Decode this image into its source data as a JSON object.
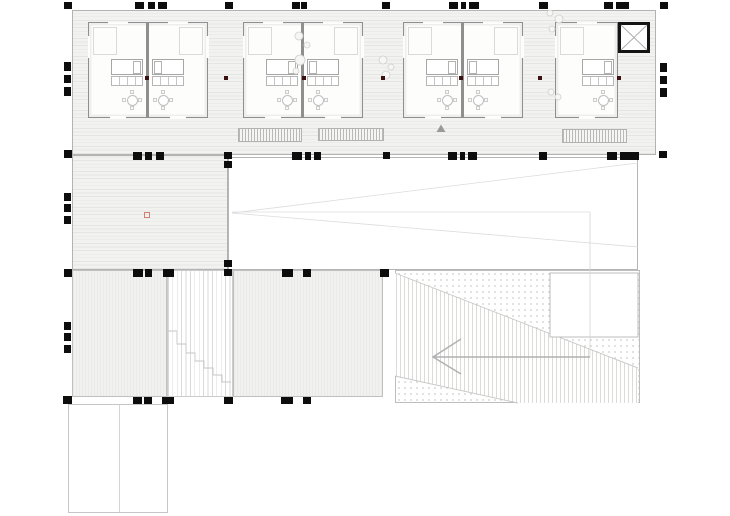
{
  "title": "architectural-roof-deck-floor-plan",
  "canvas": {
    "w": 730,
    "h": 516
  },
  "colors": {
    "background": "#ffffff",
    "deck_fill": "#f2f2f1",
    "plank_line": "#e5e5e4",
    "terrace_fill": "#f1f1f0",
    "marker_black": "#0d0d0d",
    "structural_dot": "#3c1010",
    "red_reference_square": "#d08070",
    "cabin_wall": "#8f8f8f",
    "elevator_wall": "#141414",
    "faint_line": "#dcdcdc",
    "arrow_gray": "#b0b0b0"
  },
  "regions": [
    {
      "name": "deck-band",
      "cls": "plank-h",
      "rect": [
        72,
        10,
        584,
        145
      ]
    },
    {
      "name": "deck-left-column",
      "cls": "plank-h",
      "rect": [
        72,
        155,
        156,
        115
      ]
    },
    {
      "name": "roof-void",
      "cls": "voidw",
      "rect": [
        228,
        157,
        410,
        113
      ]
    },
    {
      "name": "terrace-left",
      "cls": "stripe-v",
      "rect": [
        72,
        270,
        95,
        127
      ]
    },
    {
      "name": "stair-strip",
      "cls": "stair",
      "rect": [
        167,
        270,
        66,
        127
      ]
    },
    {
      "name": "terrace-mid",
      "cls": "stripe-v",
      "rect": [
        233,
        270,
        150,
        127
      ]
    },
    {
      "name": "ramp-area",
      "cls": "dots",
      "rect": [
        395,
        270,
        245,
        133
      ]
    },
    {
      "name": "annex",
      "cls": "annex",
      "rect": [
        68,
        404,
        100,
        109
      ]
    }
  ],
  "annex_divider_x": 119,
  "cabins": [
    {
      "name": "cabin-1",
      "rect": [
        88,
        22,
        120,
        96
      ],
      "divider": [
        145.5,
        22,
        3.5,
        96
      ],
      "rooms": [
        {
          "x": 89,
          "y": 23,
          "w": 57,
          "h": 94,
          "side": "R"
        },
        {
          "x": 149,
          "y": 23,
          "w": 58,
          "h": 94,
          "side": "L"
        }
      ]
    },
    {
      "name": "cabin-2",
      "rect": [
        243,
        22,
        120,
        96
      ],
      "divider": [
        300.5,
        22,
        3.5,
        96
      ],
      "rooms": [
        {
          "x": 244,
          "y": 23,
          "w": 57,
          "h": 94,
          "side": "R"
        },
        {
          "x": 304,
          "y": 23,
          "w": 58,
          "h": 94,
          "side": "L"
        }
      ]
    },
    {
      "name": "cabin-3",
      "rect": [
        403,
        22,
        120,
        96
      ],
      "divider": [
        460.5,
        22,
        3.5,
        96
      ],
      "rooms": [
        {
          "x": 404,
          "y": 23,
          "w": 57,
          "h": 94,
          "side": "R"
        },
        {
          "x": 464,
          "y": 23,
          "w": 58,
          "h": 94,
          "side": "L"
        }
      ]
    },
    {
      "name": "cabin-4",
      "rect": [
        555,
        22,
        63,
        96
      ],
      "divider": null,
      "rooms": [
        {
          "x": 556,
          "y": 23,
          "w": 61,
          "h": 94,
          "side": "R"
        }
      ]
    }
  ],
  "elevator": {
    "rect": [
      618,
      22,
      32,
      31
    ]
  },
  "gratings": [
    [
      238,
      128,
      64,
      14
    ],
    [
      318,
      128,
      66,
      13
    ],
    [
      562,
      129,
      65,
      14
    ]
  ],
  "markers": [
    [
      64,
      2,
      8,
      7
    ],
    [
      135,
      2,
      9,
      7
    ],
    [
      148,
      2,
      7,
      7
    ],
    [
      158,
      2,
      9,
      7
    ],
    [
      225,
      2,
      8,
      7
    ],
    [
      292,
      2,
      8,
      7
    ],
    [
      301,
      2,
      6,
      7
    ],
    [
      382,
      2,
      8,
      7
    ],
    [
      449,
      2,
      9,
      7
    ],
    [
      461,
      2,
      5,
      7
    ],
    [
      469,
      2,
      10,
      7
    ],
    [
      539,
      2,
      9,
      7
    ],
    [
      604,
      2,
      9,
      7
    ],
    [
      616,
      2,
      13,
      7
    ],
    [
      660,
      2,
      8,
      7
    ],
    [
      64,
      62,
      7,
      9
    ],
    [
      64,
      75,
      7,
      8
    ],
    [
      64,
      87,
      7,
      9
    ],
    [
      660,
      63,
      7,
      9
    ],
    [
      660,
      76,
      7,
      8
    ],
    [
      660,
      88,
      7,
      9
    ],
    [
      64,
      150,
      8,
      8
    ],
    [
      659,
      151,
      8,
      7
    ],
    [
      133,
      152,
      9,
      8
    ],
    [
      145,
      152,
      7,
      8
    ],
    [
      156,
      152,
      8,
      8
    ],
    [
      224,
      152,
      8,
      7
    ],
    [
      224,
      161,
      8,
      7
    ],
    [
      292,
      152,
      10,
      8
    ],
    [
      305,
      152,
      6,
      8
    ],
    [
      314,
      152,
      7,
      8
    ],
    [
      383,
      152,
      7,
      7
    ],
    [
      448,
      152,
      9,
      8
    ],
    [
      460,
      152,
      5,
      8
    ],
    [
      468,
      152,
      9,
      8
    ],
    [
      539,
      152,
      8,
      8
    ],
    [
      607,
      152,
      10,
      8
    ],
    [
      620,
      152,
      19,
      8
    ],
    [
      64,
      193,
      7,
      8
    ],
    [
      64,
      204,
      7,
      8
    ],
    [
      64,
      216,
      7,
      8
    ],
    [
      64,
      269,
      8,
      8
    ],
    [
      133,
      269,
      10,
      8
    ],
    [
      145,
      269,
      7,
      8
    ],
    [
      163,
      269,
      11,
      8
    ],
    [
      224,
      260,
      8,
      7
    ],
    [
      224,
      269,
      8,
      7
    ],
    [
      282,
      269,
      11,
      8
    ],
    [
      303,
      269,
      8,
      8
    ],
    [
      380,
      269,
      9,
      8
    ],
    [
      64,
      322,
      7,
      8
    ],
    [
      64,
      333,
      7,
      8
    ],
    [
      64,
      345,
      7,
      8
    ],
    [
      63,
      396,
      9,
      8
    ],
    [
      133,
      397,
      9,
      7
    ],
    [
      144,
      397,
      8,
      7
    ],
    [
      162,
      397,
      12,
      7
    ],
    [
      224,
      397,
      9,
      7
    ],
    [
      281,
      397,
      12,
      7
    ],
    [
      303,
      397,
      8,
      7
    ]
  ],
  "structural_dots": {
    "y": 76,
    "size": 4,
    "xs": [
      147,
      226,
      304,
      383,
      461,
      540,
      619
    ]
  },
  "red_square": [
    144,
    212,
    6,
    6
  ],
  "triangle_marker": "441,124.5 445.5,132 436.5,132",
  "plants": [
    [
      299,
      36,
      4
    ],
    [
      307,
      45,
      3
    ],
    [
      300,
      60,
      5
    ],
    [
      296,
      71,
      3
    ],
    [
      383,
      60,
      4
    ],
    [
      391,
      67,
      3
    ],
    [
      386,
      75,
      4
    ],
    [
      550,
      13,
      3
    ],
    [
      559,
      19,
      4
    ],
    [
      552,
      29,
      3
    ],
    [
      551,
      92,
      3
    ],
    [
      558,
      97,
      3
    ]
  ],
  "faint_lines": [
    [
      232,
      212,
      590,
      212
    ],
    [
      232,
      213,
      638,
      163
    ],
    [
      232,
      213,
      638,
      247
    ],
    [
      550,
      330,
      638,
      330
    ]
  ],
  "vline_590": [
    590,
    212,
    590,
    357
  ],
  "ramp": {
    "stripe_polygon": "395,273 638,368 638,403 518,403 395,376",
    "edge1": [
      395,
      273,
      638,
      368
    ],
    "edge2": [
      395,
      376,
      518,
      403
    ],
    "inset_rect": [
      550,
      273,
      88,
      64
    ]
  },
  "stair_steps_path": "M168,331h9v13h9v9h9v8h9v7h9v7h9v7h9",
  "arrow": {
    "shaft": [
      590,
      357,
      433,
      357
    ],
    "head": "461,339 433,357 461,374"
  }
}
